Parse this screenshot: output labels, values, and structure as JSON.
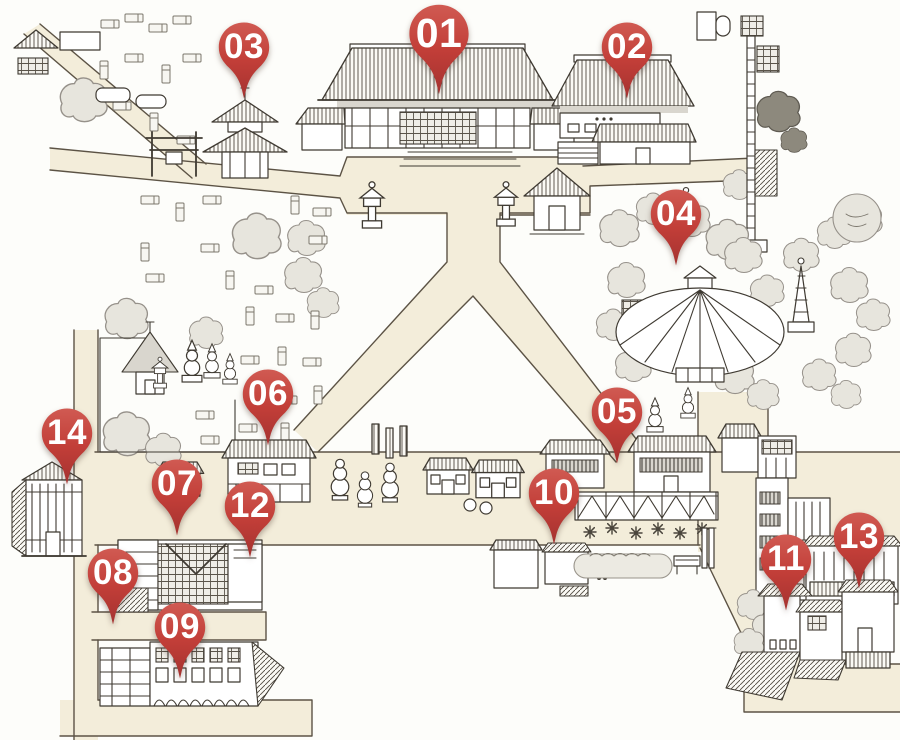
{
  "map": {
    "description": "Hand-drawn illustrated temple-district map with numbered location markers",
    "marker_count": 14
  },
  "pins": [
    {
      "label": "01",
      "x": 439,
      "y": 97,
      "size": "large"
    },
    {
      "label": "02",
      "x": 627,
      "y": 101
    },
    {
      "label": "03",
      "x": 244,
      "y": 101
    },
    {
      "label": "04",
      "x": 676,
      "y": 268
    },
    {
      "label": "05",
      "x": 617,
      "y": 466
    },
    {
      "label": "06",
      "x": 268,
      "y": 448
    },
    {
      "label": "07",
      "x": 177,
      "y": 538
    },
    {
      "label": "08",
      "x": 113,
      "y": 627
    },
    {
      "label": "09",
      "x": 180,
      "y": 681
    },
    {
      "label": "10",
      "x": 554,
      "y": 547
    },
    {
      "label": "11",
      "x": 786,
      "y": 613
    },
    {
      "label": "12",
      "x": 250,
      "y": 560
    },
    {
      "label": "13",
      "x": 859,
      "y": 591
    },
    {
      "label": "14",
      "x": 67,
      "y": 487
    }
  ],
  "colors": {
    "pin_top": "#d05a52",
    "pin_mid": "#c23e38",
    "pin_bottom": "#a43230",
    "path_fill": "#f3edda",
    "path_stroke": "#5c5345",
    "ink": "#3f3a32",
    "paper": "#fdfdfa"
  }
}
